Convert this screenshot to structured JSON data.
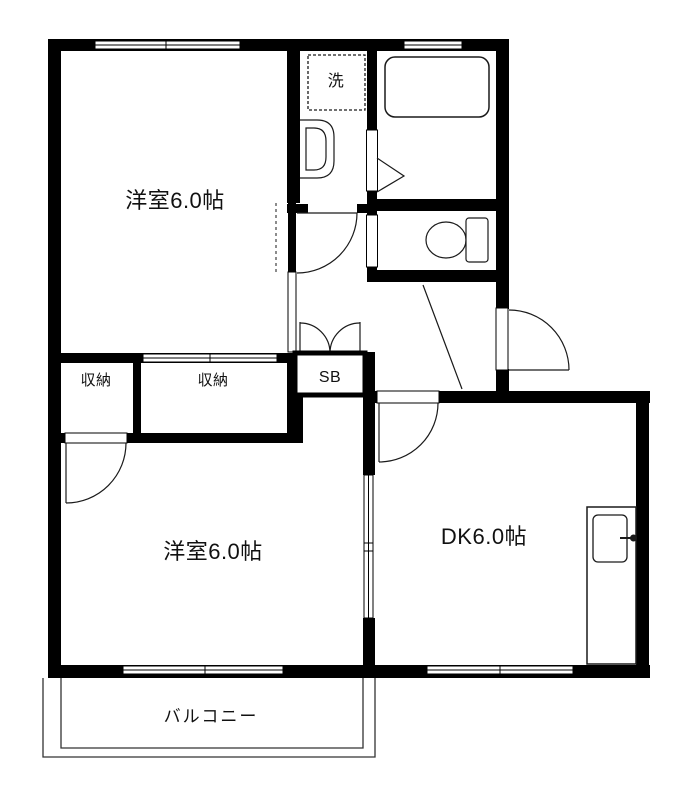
{
  "colors": {
    "wall": "#000000",
    "background": "#ffffff",
    "line": "#1a1a1a"
  },
  "rooms": {
    "bedroom_top": {
      "label": "洋室6.0帖"
    },
    "bedroom_bottom": {
      "label": "洋室6.0帖"
    },
    "dining_kitchen": {
      "label": "DK6.0帖"
    },
    "closet_left": {
      "label": "収納"
    },
    "closet_right": {
      "label": "収納"
    },
    "shoe_box": {
      "label": "SB"
    },
    "laundry": {
      "label": "洗"
    },
    "balcony": {
      "label": "バルコニー"
    }
  }
}
